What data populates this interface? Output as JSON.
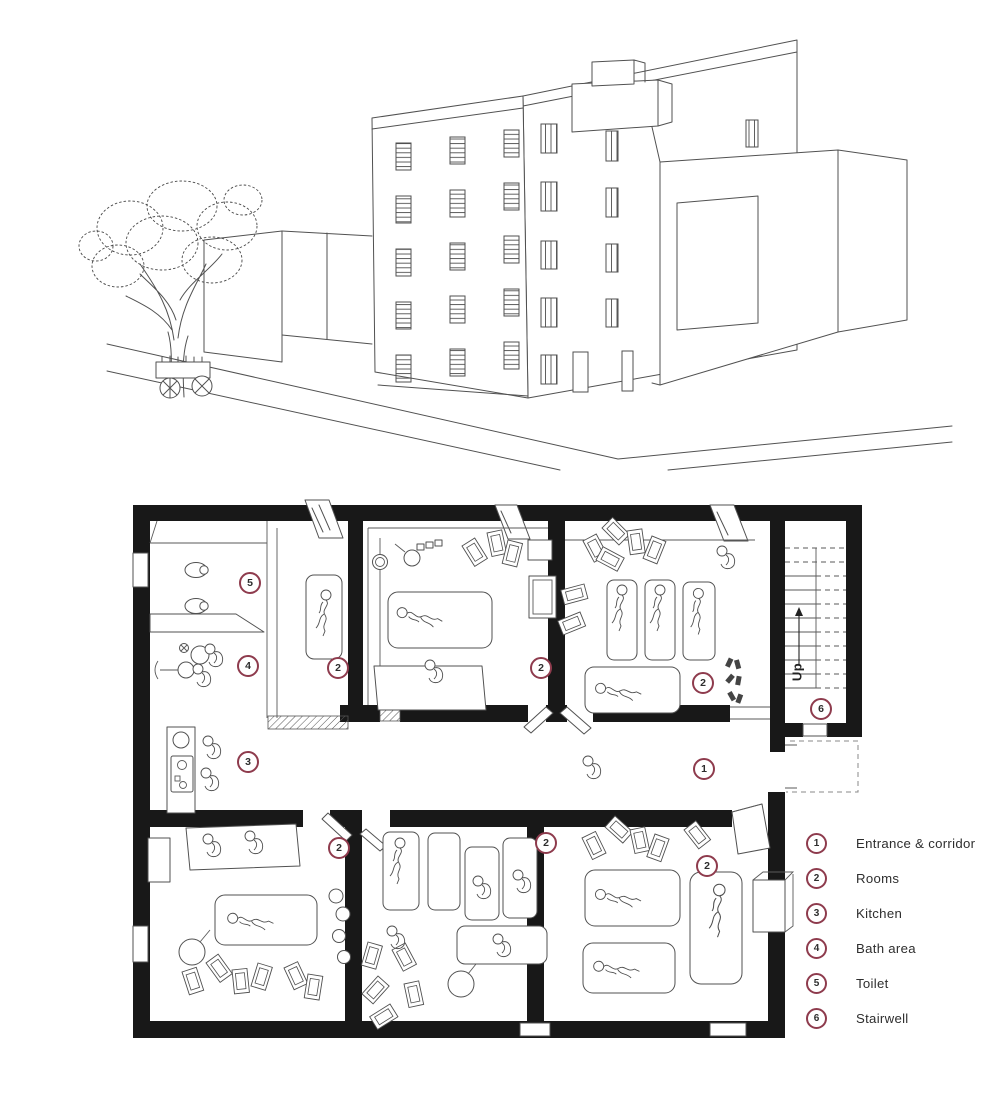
{
  "palette": {
    "accent": "#8e3b4d",
    "line": "#515151",
    "wall": "#181818",
    "text": "#2e2e2e"
  },
  "plan": {
    "stairwell": {
      "up_label": "Up"
    },
    "markers": {
      "corridor": "1",
      "room_top_left": "2",
      "room_top_middle": "2",
      "room_top_right": "2",
      "room_bottom_left": "2",
      "room_bottom_middle": "2",
      "room_bottom_right": "2",
      "kitchen": "3",
      "bath": "4",
      "toilet": "5",
      "stairwell": "6"
    }
  },
  "legend": {
    "items": [
      {
        "number": "1",
        "label": "Entrance & corridor"
      },
      {
        "number": "2",
        "label": "Rooms"
      },
      {
        "number": "3",
        "label": "Kitchen"
      },
      {
        "number": "4",
        "label": "Bath area"
      },
      {
        "number": "5",
        "label": "Toilet"
      },
      {
        "number": "6",
        "label": "Stairwell"
      }
    ]
  }
}
